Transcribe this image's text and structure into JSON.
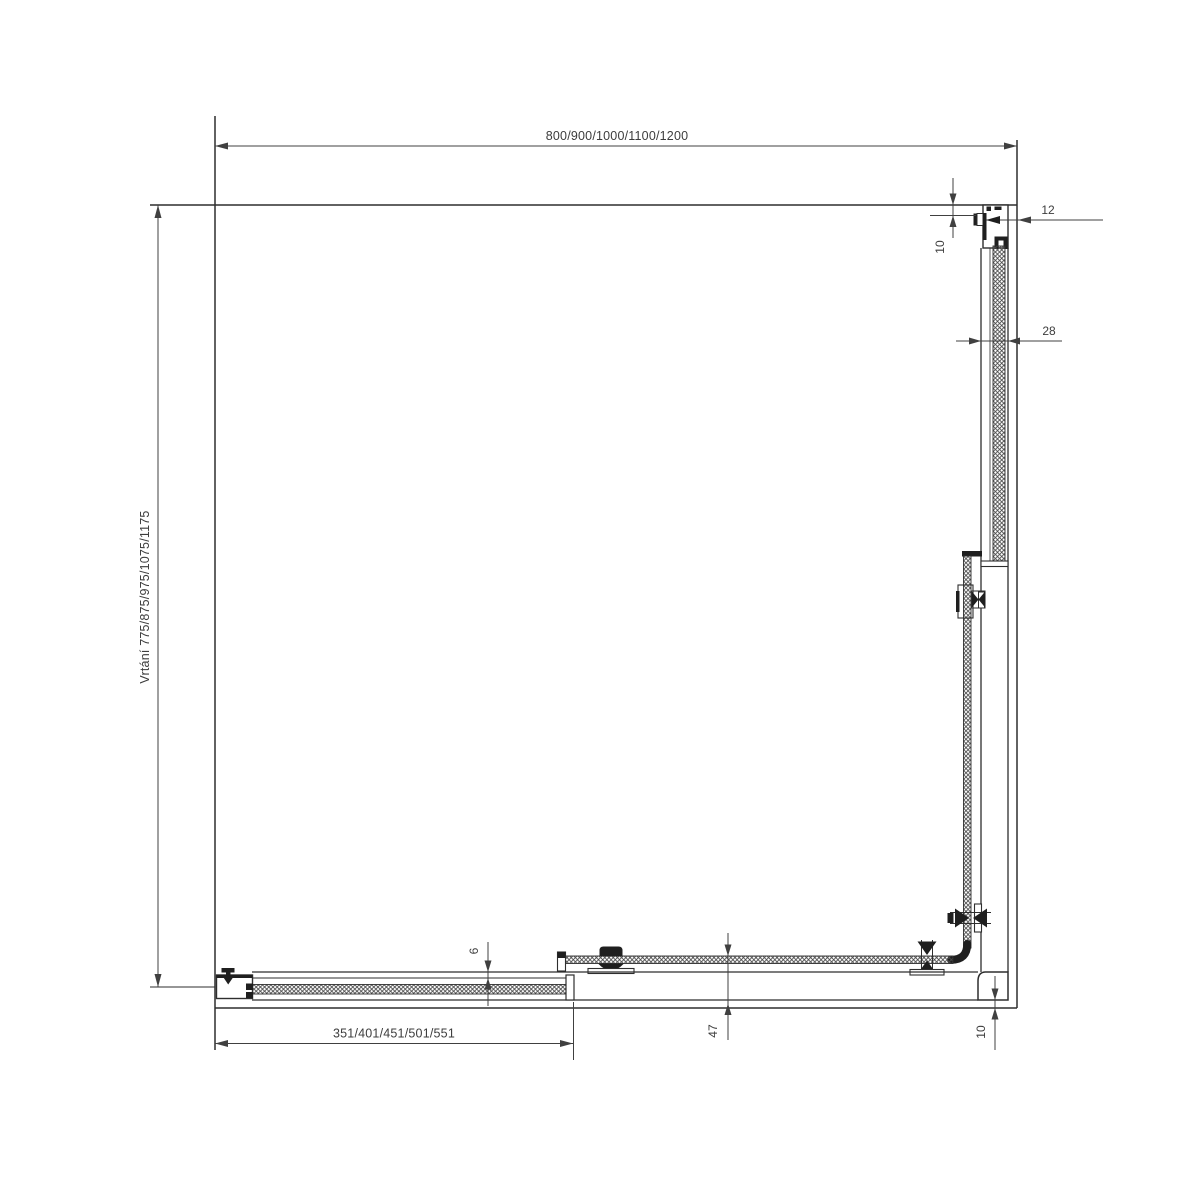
{
  "drawing": {
    "labels": {
      "top_width": "800/900/1000/1100/1200",
      "left_drilling": "Vrtání 775/875/975/1075/1175",
      "bottom_door": "351/401/451/501/551",
      "profile_depth": "12",
      "wall_gap_top": "10",
      "profile_width": "28",
      "rail_gap": "6",
      "rail_height": "47",
      "corner_gap_bottom": "10"
    },
    "colors": {
      "outline": "#2e2e2e",
      "dimension": "#404040",
      "dark_fill": "#1f1f1f",
      "background": "#ffffff"
    }
  }
}
